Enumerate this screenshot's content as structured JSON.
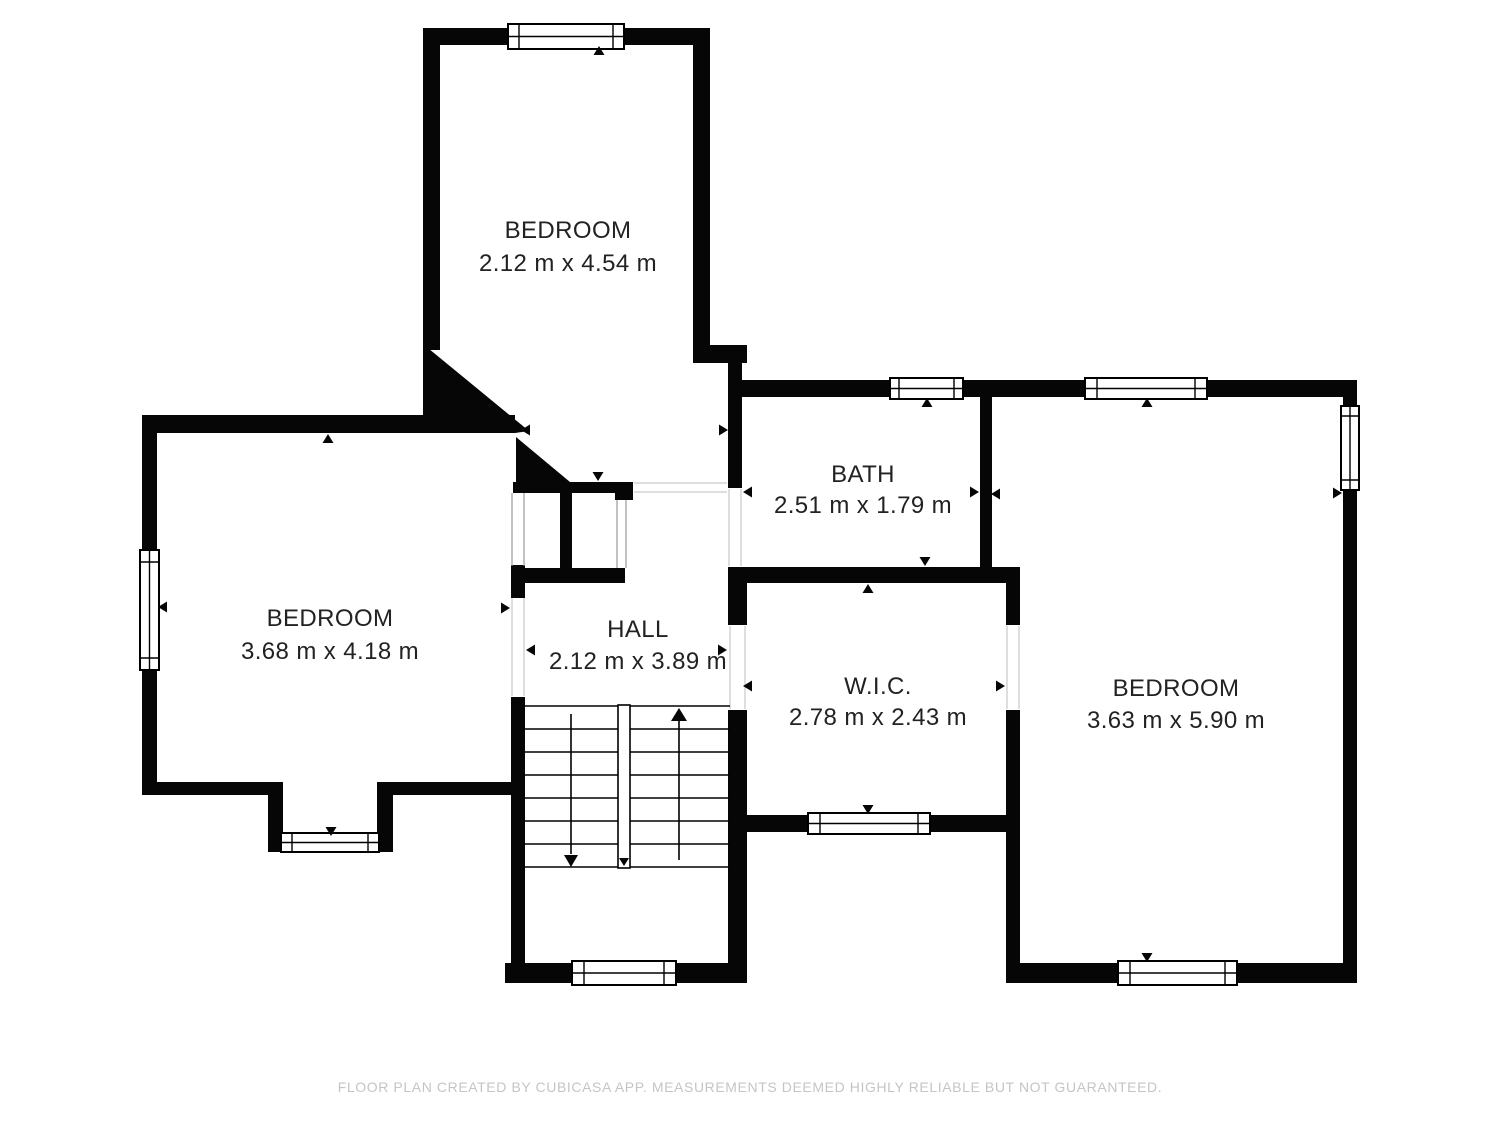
{
  "rooms": [
    {
      "key": "bedroom-top",
      "name": "BEDROOM",
      "dims": "2.12 m x 4.54 m"
    },
    {
      "key": "bedroom-left",
      "name": "BEDROOM",
      "dims": "3.68 m x 4.18 m"
    },
    {
      "key": "hall",
      "name": "HALL",
      "dims": "2.12 m x 3.89 m"
    },
    {
      "key": "bath",
      "name": "BATH",
      "dims": "2.51 m x 1.79 m"
    },
    {
      "key": "wic",
      "name": "W.I.C.",
      "dims": "2.78 m x 2.43 m"
    },
    {
      "key": "bedroom-right",
      "name": "BEDROOM",
      "dims": "3.63 m x 5.90 m"
    }
  ],
  "footer": {
    "disclaimer": "FLOOR PLAN CREATED BY CUBICASA APP. MEASUREMENTS DEEMED HIGHLY RELIABLE BUT NOT GUARANTEED."
  },
  "colors": {
    "wall": "#060606",
    "room_text": "#222222",
    "disclaimer_text": "#c5c5c5",
    "background": "#ffffff"
  }
}
